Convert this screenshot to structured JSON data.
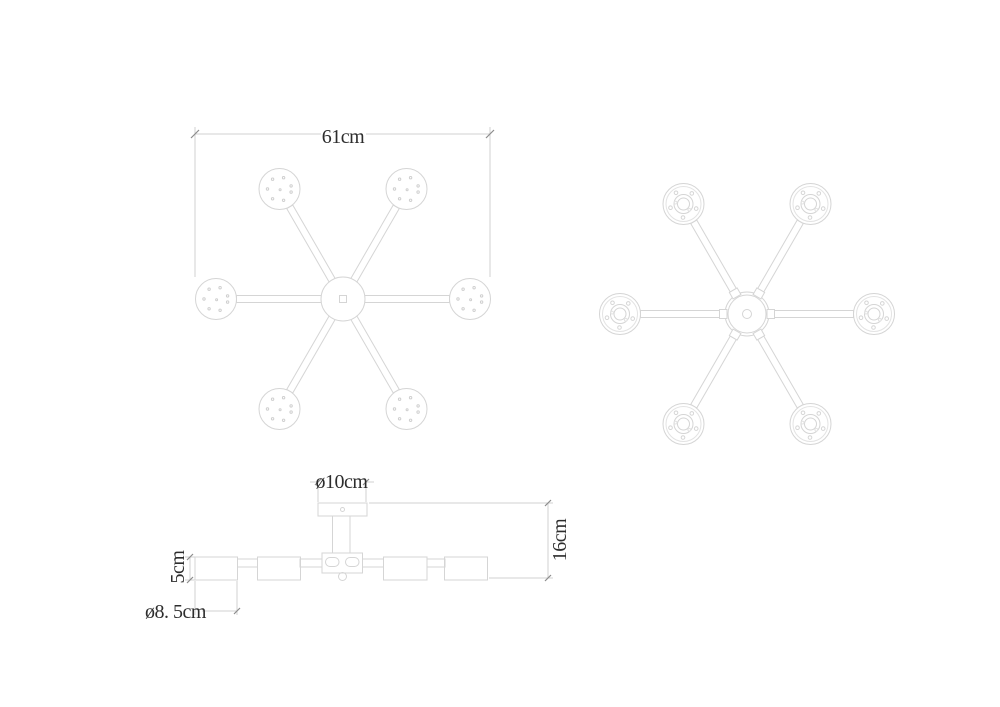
{
  "page": {
    "background_color": "#ffffff"
  },
  "drawing": {
    "lamp_count": 6,
    "labels": {
      "plan_width": "61cm",
      "canopy_diameter": "ø10cm",
      "total_height": "16cm",
      "shade_height": "5cm",
      "shade_diameter": "ø8. 5cm"
    },
    "colors": {
      "line": "#d5d5d5",
      "dimension_line": "#d2d2d2",
      "tick": "#8c8c8c",
      "text": "#2d2d2d"
    }
  }
}
